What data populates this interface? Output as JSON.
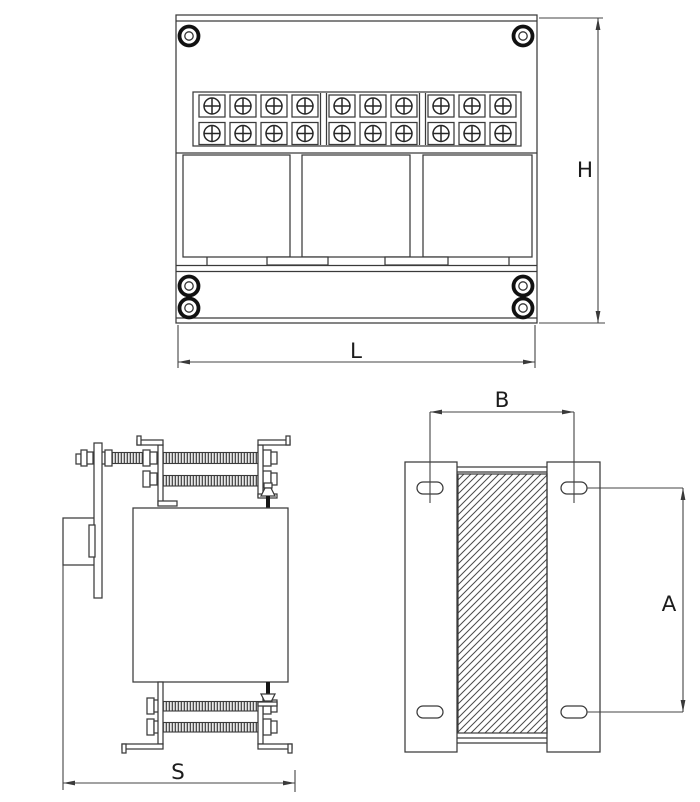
{
  "drawing": {
    "type": "technical-dimensional-drawing",
    "subject": "three-phase-transformer",
    "background": "#ffffff",
    "line_color": "#3a3a3a",
    "dimensions": {
      "height": "H",
      "length": "L",
      "depth": "S",
      "slot_span": "B",
      "slot_pitch": "A"
    },
    "front_view": {
      "coil_count": 3,
      "top_screws": 2,
      "bottom_screws": 4,
      "terminal_block": {
        "rows": 2,
        "groups": [
          4,
          3,
          3
        ],
        "total_terminals": 20
      }
    },
    "side_view": {
      "tie_rods_top": 2,
      "tie_rods_bottom": 2
    },
    "top_view": {
      "mounting_slots": 4,
      "hatched_core": true
    }
  }
}
